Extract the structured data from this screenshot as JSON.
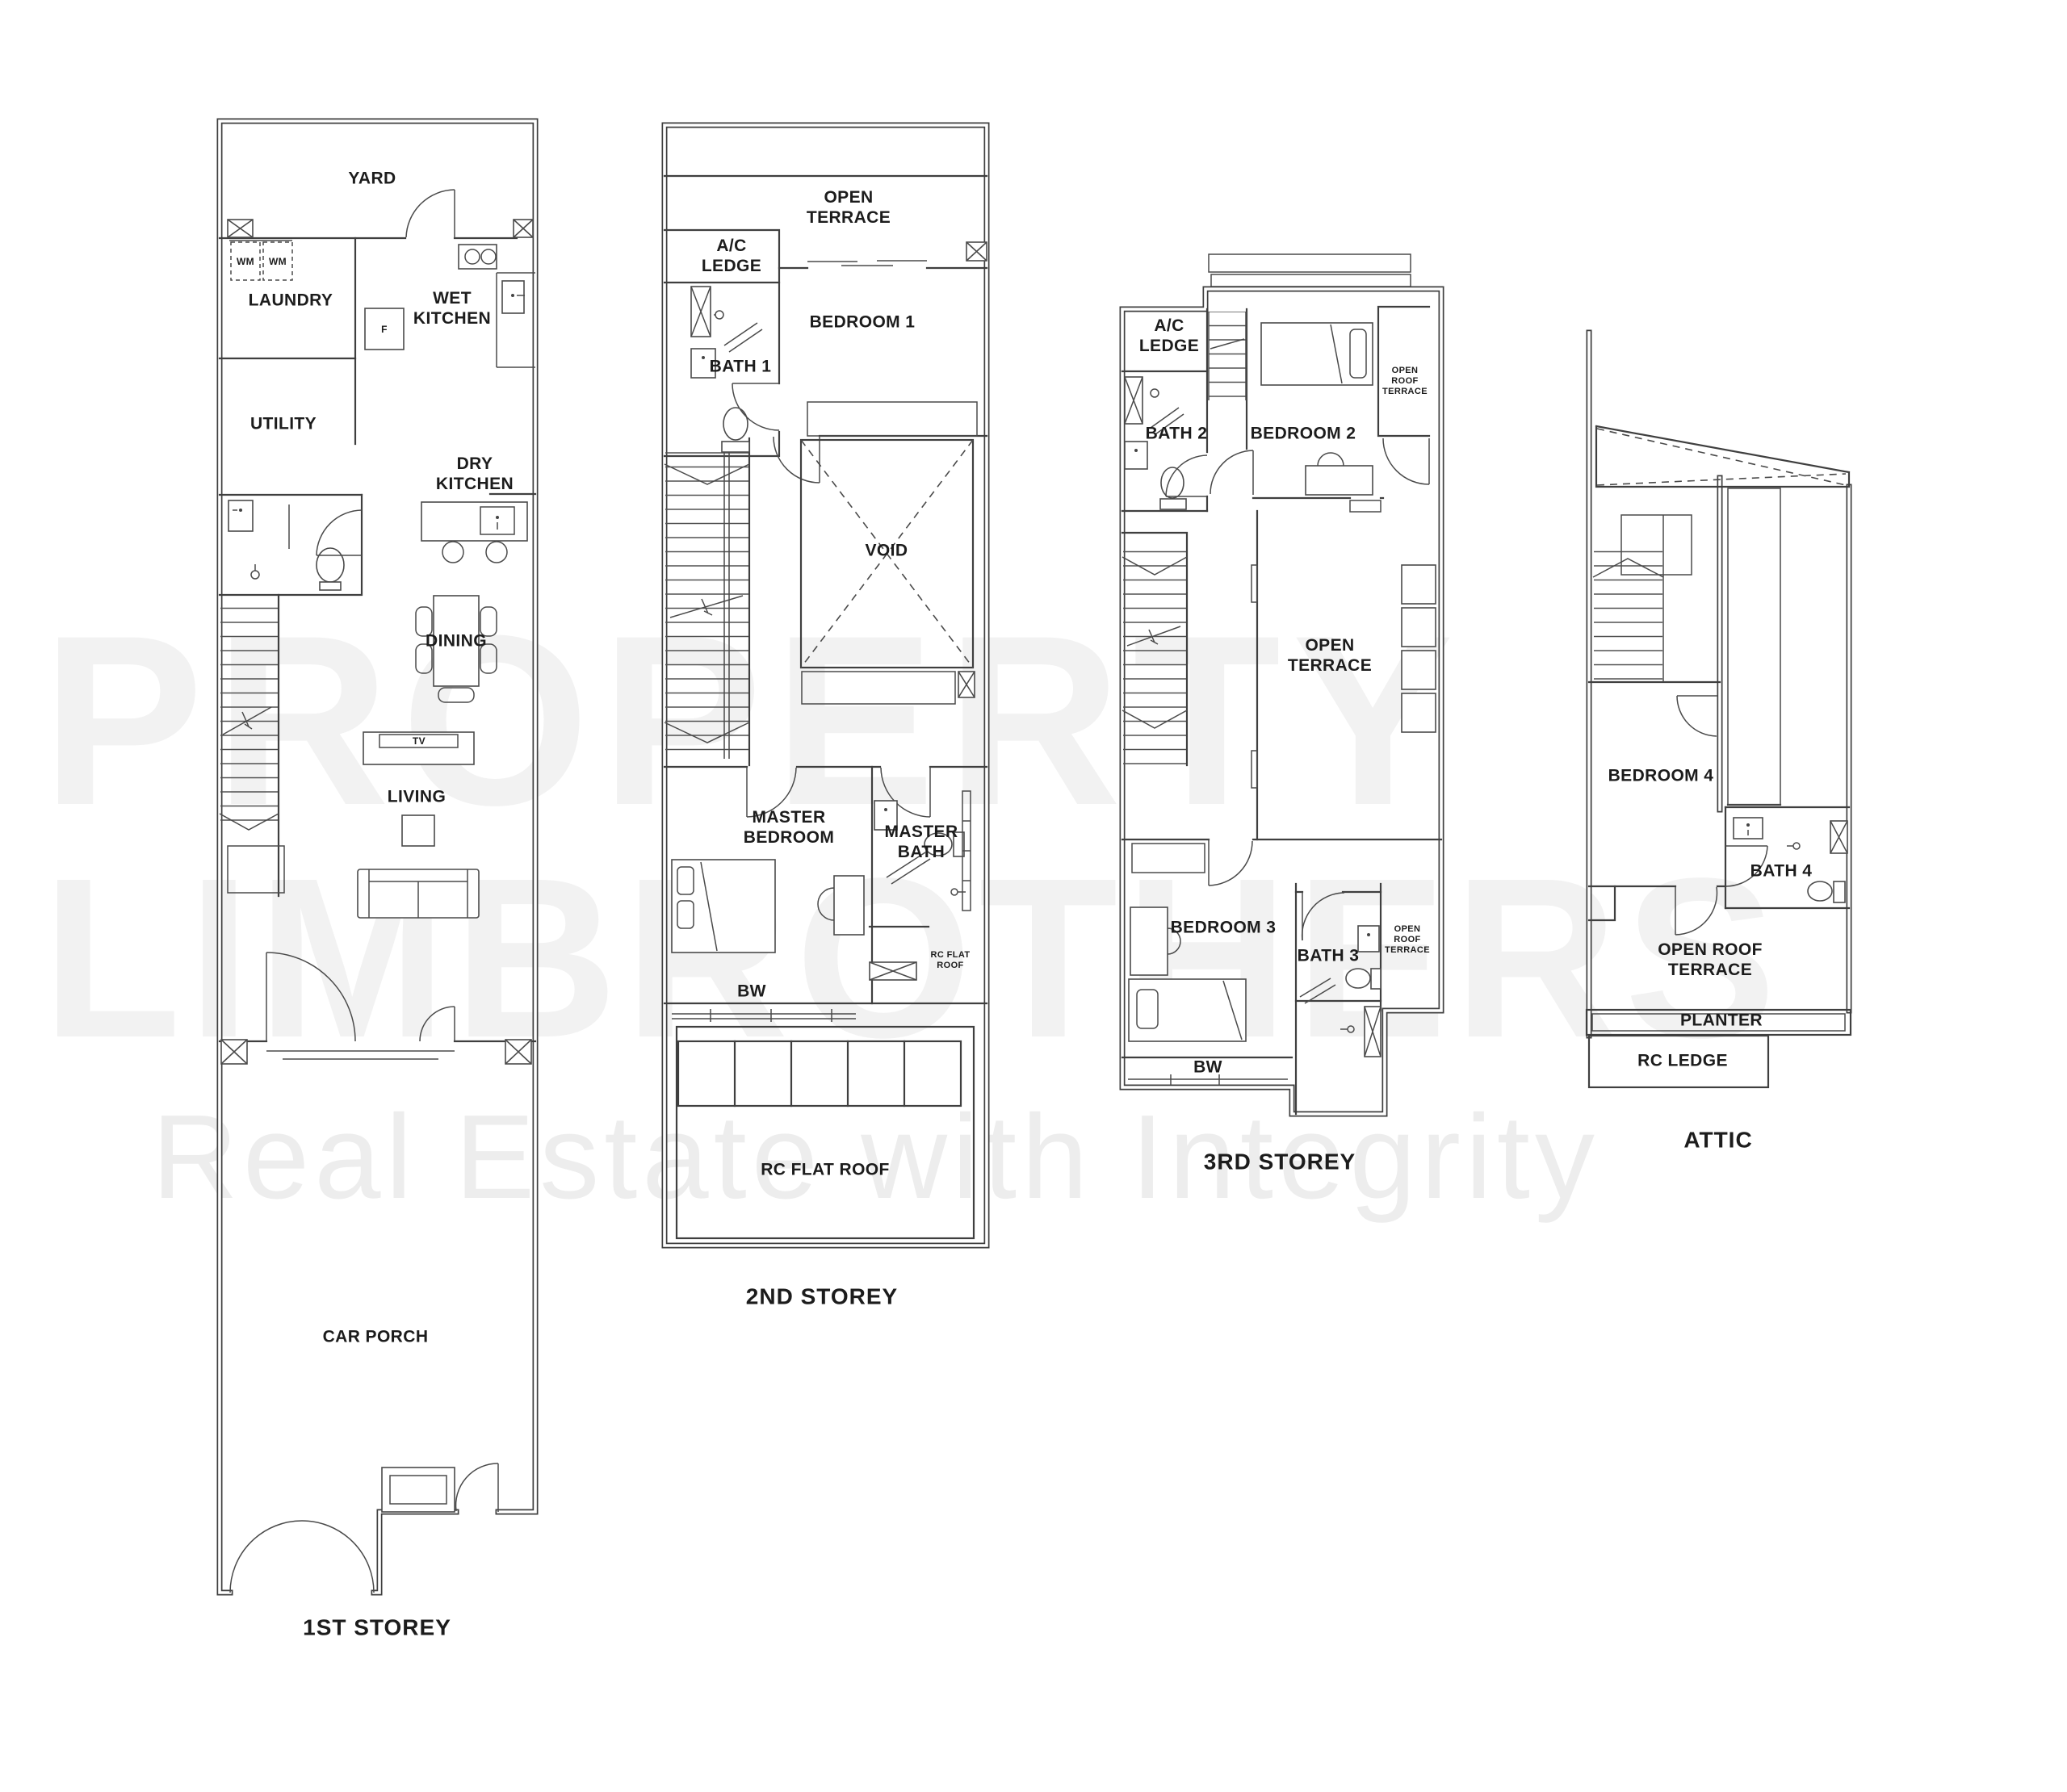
{
  "document": {
    "type": "floor-plan-drawing",
    "storeys": [
      "1ST STOREY",
      "2ND STOREY",
      "3RD STOREY",
      "ATTIC"
    ]
  },
  "watermark": {
    "line1": "PROPERTY",
    "line2": "LIMBROTHERS",
    "tagline": "Real Estate with Integrity",
    "color_big": "#f2f2f2",
    "color_tagline": "#ededed"
  },
  "floors": {
    "first": {
      "caption": "1ST STOREY",
      "labels": {
        "yard": "YARD",
        "wm1": "WM",
        "wm2": "WM",
        "laundry": "LAUNDRY",
        "wet_kitchen": "WET\nKITCHEN",
        "fridge": "F",
        "utility": "UTILITY",
        "dry_kitchen": "DRY\nKITCHEN",
        "dining": "DINING",
        "tv": "TV",
        "living": "LIVING",
        "car_porch": "CAR PORCH"
      }
    },
    "second": {
      "caption": "2ND STOREY",
      "labels": {
        "ac_ledge": "A/C\nLEDGE",
        "open_terrace": "OPEN\nTERRACE",
        "bath1": "BATH 1",
        "bedroom1": "BEDROOM 1",
        "void": "VOID",
        "master_bedroom": "MASTER\nBEDROOM",
        "master_bath": "MASTER\nBATH",
        "rc_flat_roof_small": "RC FLAT\nROOF",
        "bw": "BW",
        "rc_flat_roof": "RC FLAT ROOF"
      }
    },
    "third": {
      "caption": "3RD STOREY",
      "labels": {
        "ac_ledge": "A/C\nLEDGE",
        "bath2": "BATH 2",
        "bedroom2": "BEDROOM 2",
        "open_roof_terrace_top": "OPEN\nROOF\nTERRACE",
        "open_terrace": "OPEN\nTERRACE",
        "bedroom3": "BEDROOM 3",
        "bath3": "BATH 3",
        "open_roof_terrace_bottom": "OPEN\nROOF\nTERRACE",
        "bw": "BW"
      }
    },
    "attic": {
      "caption": "ATTIC",
      "labels": {
        "bedroom4": "BEDROOM 4",
        "bath4": "BATH 4",
        "open_roof_terrace": "OPEN ROOF\nTERRACE",
        "planter": "PLANTER",
        "rc_ledge": "RC LEDGE"
      }
    }
  }
}
